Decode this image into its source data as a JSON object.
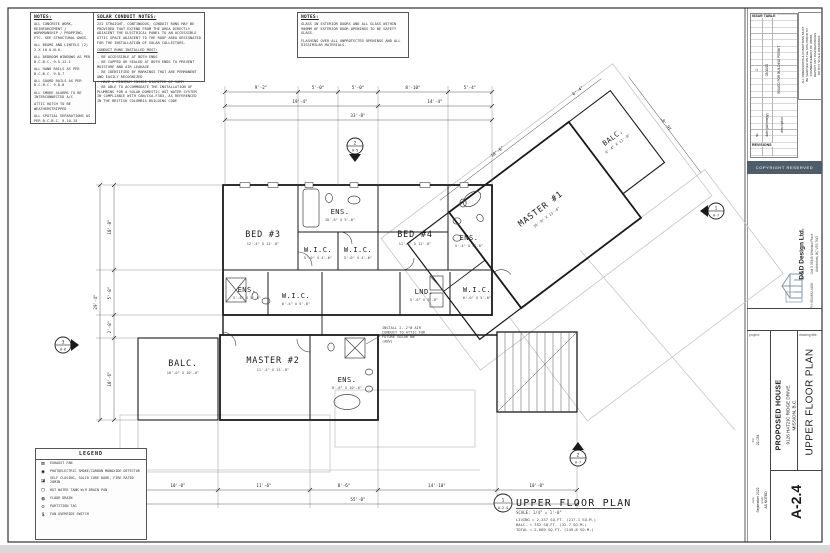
{
  "notes_left": {
    "title": "NOTES:",
    "items": [
      "ALL CONCRETE WORK, REINFORCEMENT / WORKMANSHIP / PROPPING, ETC. SEE STRUCTURAL DWGS.",
      "ALL BEAMS AND LINTELS (2) 2 X 10 U.N.O.",
      "ALL BEDROOM WINDOWS AS PER B.C.B.C. 9.5.12.1",
      "ALL HAND RAILS AS PER B.C.B.C. 9.8.7",
      "ALL GUARD RAILS AS PER B.C.B.C. 9.8.8",
      "ALL SMOKE ALARMS TO BE INTERCONNECTED A/C",
      "ATTIC HATCH TO BE WEATHERSTRIPPED",
      "ALL SPATIAL SEPARATIONS AS PER B.C.B.C. 9.10.15"
    ]
  },
  "notes_solar": {
    "title": "SOLAR CONDUIT NOTES:",
    "intro": "2X2 STRAIGHT, CONTINUOUS, CONDUIT RUNS MAY BE PROVIDED THAT EXTEND FROM THE AREA DIRECTLY ADJACENT THE ELECTRICAL PANEL TO AN ACCESSIBLE ATTIC SPACE ADJACENT TO THE ROOF AREA DESIGNATED FOR THE INSTALLATION OF SOLAR COLLECTORS.",
    "subhead": "CONDUIT RUNS INSTALLED MUST:",
    "bullets": [
      "- BE ACCESSIBLE AT BOTH ENDS",
      "- BE CAPPED OR SEALED AT BOTH ENDS TO PREVENT MOISTURE AND AIR LEAKAGE",
      "- BE IDENTIFIED BY MARKINGS THAT ARE PERMANENT AND EASILY RECOGNIZED",
      "- HAVE A MINIMUM INSIDE DIAMETER OF 50MM",
      "- BE ABLE TO ACCOMMODATE THE INSTALLATION OF PLUMBING FOR A SOLAR DOMESTIC HOT WATER SYSTEM IN COMPLIANCE WITH CAN/CSA-F383, AS REFERENCED IN THE BRITISH COLUMBIA BUILDING CODE"
    ]
  },
  "notes_right": {
    "title": "NOTES:",
    "items": [
      "GLASS IN EXTERIOR DOORS AND ALL GLASS WITHIN 900MM OF EXTERIOR DOOR OPENINGS TO BE SAFETY GLASS.",
      "FLASHING OVER ALL UNPROTECTED OPENINGS AND ALL DISSIMILAR MATERIALS."
    ]
  },
  "legend": {
    "title": "LEGEND",
    "items": [
      {
        "glyph": "⊠",
        "label": "EXHAUST FAN"
      },
      {
        "glyph": "◉",
        "label": "PHOTOELECTRIC SMOKE/CARBON MONOXIDE DETECTOR"
      },
      {
        "glyph": "◪",
        "label": "SELF CLOSING, SOLID CORE DOOR, FIRE RATED 20MIN"
      },
      {
        "glyph": "▢",
        "label": "HOT WATER TANK W/H DRAIN PAN"
      },
      {
        "glyph": "◍",
        "label": "FLOOR DRAIN"
      },
      {
        "glyph": "◇",
        "label": "PARTITION TAG"
      },
      {
        "glyph": "$",
        "label": "FAN OVERRIDE SWITCH"
      }
    ]
  },
  "plan": {
    "rooms": [
      {
        "label": "BED #3",
        "size": "12'-4\" X 11'-0\""
      },
      {
        "label": "ENS.",
        "size": "10'-6\" X 5'-0\""
      },
      {
        "label": "W.I.C.",
        "size": "5'-0\" X 4'-6\""
      },
      {
        "label": "W.I.C.",
        "size": "5'-0\" X 4'-6\""
      },
      {
        "label": "BED #4",
        "size": "11'-6\" X 12'-0\""
      },
      {
        "label": "ENS.",
        "size": "5'-4\" X 9'-8\""
      },
      {
        "label": "ENS.",
        "size": "5'-4\" X 5'-0\""
      },
      {
        "label": "W.I.C.",
        "size": "6'-4\" X 5'-0\""
      },
      {
        "label": "LND.",
        "size": "5'-6\" X 5'-0\""
      },
      {
        "label": "W.I.C.",
        "size": "6'-0\" X 5'-0\""
      },
      {
        "label": "BALC.",
        "size": "10'-0\" X 10'-0\""
      },
      {
        "label": "MASTER #2",
        "size": "11'-4\" X 13'-8\""
      },
      {
        "label": "ENS.",
        "size": "8'-6\" X 10'-6\""
      },
      {
        "label": "MASTER #1",
        "size": "16'-0\" X 13'-6\""
      },
      {
        "label": "BALC.",
        "size": "6'-4\" X 11'-0\""
      }
    ],
    "dims_top": [
      "9'-2\"",
      "5'-0\"",
      "5'-0\"",
      "8'-10\"",
      "5'-4\"",
      "19'-4\"",
      "14'-4\"",
      "33'-8\""
    ],
    "dims_left": [
      "10'-8\"",
      "5'-8\"",
      "2'-8\"",
      "10'-6\"",
      "29'-4\""
    ],
    "dims_bottom": [
      "10'-0\"",
      "11'-6\"",
      "8'-6\"",
      "14'-10\"",
      "10'-0\"",
      "55'-0\""
    ],
    "dims_wing": [
      "18'-8\"",
      "6'-4\"",
      "16'-0\""
    ],
    "conduit_note": [
      "INSTALL 2- 2\"Ø AIR",
      "CONDUIT TO ATTIC FOR",
      "FUTURE SOLAR HW",
      "(ABV)"
    ],
    "markers": [
      {
        "num": "3",
        "sheet": "A-6"
      },
      {
        "num": "2",
        "sheet": "A-5"
      },
      {
        "num": "1",
        "sheet": "A-7"
      },
      {
        "num": "2",
        "sheet": "A-7"
      }
    ],
    "title": {
      "ref_num": "1",
      "ref_sheet": "A-2.4",
      "name": "UPPER FLOOR PLAN",
      "scale": "SCALE: 1/4\" = 1'-0\"",
      "areas": [
        "LIVING = 2,337 SQ.FT. (217.1 SQ.M.)",
        "BALC.  =   352 SQ.FT. (32.7 SQ.M.)",
        "TOTAL = 2,689 SQ.FT. (249.8 SQ.M.)"
      ]
    }
  },
  "titleblock": {
    "issue_table_label": "ISSUE TABLE",
    "issue_col_no": "no.",
    "issue_col_date": "date (dd/mm/yy)",
    "issue_col_desc": "description",
    "issue_row_no": "1",
    "issue_row_date": "03/10/22",
    "issue_row_desc": "ISSUED FOR BUILDING PERMIT",
    "revisions_label": "REVISIONS",
    "rev_col_no": "no.",
    "rev_col_date": "date",
    "rev_col_desc": "description",
    "disclaimer_1": "ALL DIMENSIONS & CONDITIONS MUST",
    "disclaimer_2": "BE VERIFIED ON THE SITE PRIOR TO",
    "disclaimer_3": "COMMENCEMENT OF WORK.",
    "disclaimer_4": "REPORT ANY DISCREPANCIES",
    "disclaimer_5": "DO NOT SCALE DRAWINGS.",
    "band_text": "COPYRIGHT RESERVED",
    "firm_name": "D&D Design Ltd.",
    "firm_addr1": "Unit 3  33345 Whitelaw Place",
    "firm_addr2": "Abbotsford, BC  V2S 7W2",
    "firm_phone": "PH: 604.852.4406",
    "project_label": "project:",
    "title_label": "drawing title:",
    "project_1": "PROPOSED HOUSE",
    "project_2": "9126 HATZIC RIDGE DRIVE",
    "project_3": "MISSION, B.C.",
    "sheet_title": "UPPER FLOOR PLAN",
    "sheet_no": "A-2.4",
    "fields": [
      {
        "label": "date:",
        "value": "September 2022"
      },
      {
        "label": "scale:",
        "value": "AS NOTED"
      },
      {
        "label": "file:",
        "value": "22-034"
      }
    ]
  }
}
